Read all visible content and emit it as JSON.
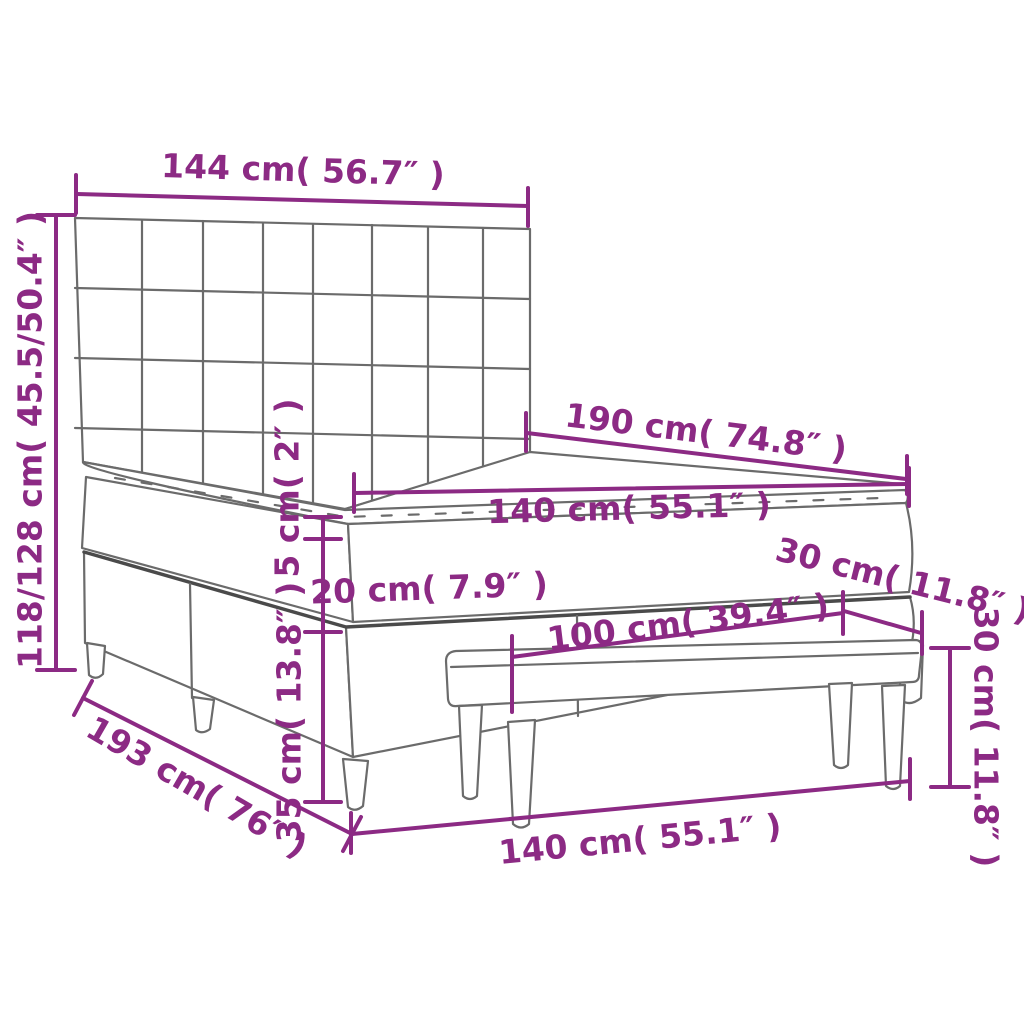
{
  "meta": {
    "title": "Box spring bed with headboard and bench — dimension diagram"
  },
  "colors": {
    "dimension": "#8C2A84",
    "line": "#6B6B6B",
    "line_dark": "#4A4A4A",
    "background": "#FFFFFF"
  },
  "labels": {
    "headboard_width": "144 cm( 56.7″ )",
    "overall_height": "118/128 cm( 45.5/50.4″ )",
    "bed_length": "190 cm( 74.8″ )",
    "mattress_width": "140 cm( 55.1″ )",
    "topper_thickness": "5 cm( 2″ )",
    "mattress_thickness": "20 cm( 7.9″ )",
    "base_height": "35 cm( 13.8″ )",
    "floor_length": "193 cm( 76″ )",
    "floor_width": "140 cm( 55.1″ )",
    "bench_length": "100 cm( 39.4″ )",
    "bench_depth": "30 cm( 11.8″ )",
    "bench_height": "30 cm( 11.8″ )"
  }
}
